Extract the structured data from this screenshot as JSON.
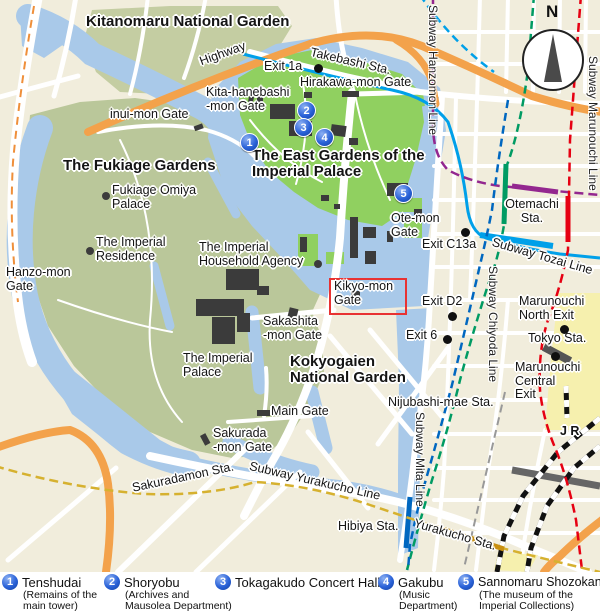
{
  "compass": {
    "north_label": "N"
  },
  "areas": {
    "kitanomaru": "Kitanomaru National Garden",
    "fukiage_gardens": "The Fukiage Gardens",
    "east_gardens": "The East Gardens of the\nImperial Palace",
    "kokyogaien": "Kokyogaien\nNational Garden"
  },
  "places": {
    "fukiage_omiya": "Fukiage Omiya\nPalace",
    "imperial_residence": "The Imperial\nResidence",
    "household_agency": "The Imperial\nHousehold Agency",
    "imperial_palace": "The Imperial\nPalace"
  },
  "gates": {
    "inui": "inui-mon Gate",
    "kita_hanebashi": "Kita-hanebashi\n-mon Gate",
    "hirakawa": "Hirakawa-mon Gate",
    "hanzo": "Hanzo-mon\nGate",
    "ote": "Ote-mon\nGate",
    "kikyo": "Kikyo-mon\nGate",
    "sakashita": "Sakashita\n-mon Gate",
    "main": "Main Gate",
    "sakurada": "Sakurada\n-mon Gate"
  },
  "stations": {
    "takebashi": "Takebashi Sta.",
    "otemachi": "Otemachi\nSta.",
    "tokyo": "Tokyo Sta.",
    "nijubashi_mae": "Nijubashi-mae Sta.",
    "sakuradamon": "Sakuradamon Sta.",
    "hibiya": "Hibiya Sta.",
    "yurakucho": "Yurakucho Sta.",
    "jr": "J R"
  },
  "exits": {
    "exit_1a": "Exit 1a",
    "exit_c13a": "Exit C13a",
    "exit_d2": "Exit D2",
    "exit_6": "Exit 6",
    "marunouchi_north": "Marunouchi\nNorth Exit",
    "marunouchi_central": "Marunouchi\nCentral\nExit"
  },
  "roads": {
    "highway": "Highway"
  },
  "subway_lines": {
    "hanzomon": "Subway Hanzomon Line",
    "marunouchi": "Subway Marunouchi Line",
    "tozai": "Subway Tozai Line",
    "chiyoda": "Subway Chiyoda Line",
    "mita": "Subway Mita Line",
    "yurakucho": "Subway Yurakucho Line"
  },
  "markers": {
    "m1": "1",
    "m2": "2",
    "m3": "3",
    "m4": "4",
    "m5": "5"
  },
  "legend": {
    "items": [
      {
        "num": "1",
        "name": "Tenshudai",
        "desc": "(Remains of the\nmain tower)"
      },
      {
        "num": "2",
        "name": "Shoryobu",
        "desc": "(Archives and\nMausolea Department)"
      },
      {
        "num": "3",
        "name": "Tokagakudo Concert Hall",
        "desc": ""
      },
      {
        "num": "4",
        "name": "Gakubu",
        "desc": "(Music\nDepartment)"
      },
      {
        "num": "5",
        "name": "Sannomaru Shozokan",
        "desc": "(The museum of the\nImperial Collections)"
      }
    ]
  },
  "colors": {
    "water": "#a9c9e9",
    "park_green": "#bac79a",
    "kitanomaru_green": "#c4cda2",
    "east_gardens_green": "#90d060",
    "highway_orange": "#f3a24b",
    "building": "#3b3b3b",
    "marker_blue": "#2a62d8",
    "highlight_red": "#e83232",
    "line_hanzomon": "#93278f",
    "line_marunouchi": "#e60012",
    "line_tozai": "#00a0e9",
    "line_chiyoda": "#009b63",
    "line_mita": "#0067c0",
    "line_yurakucho": "#d6b12f"
  }
}
